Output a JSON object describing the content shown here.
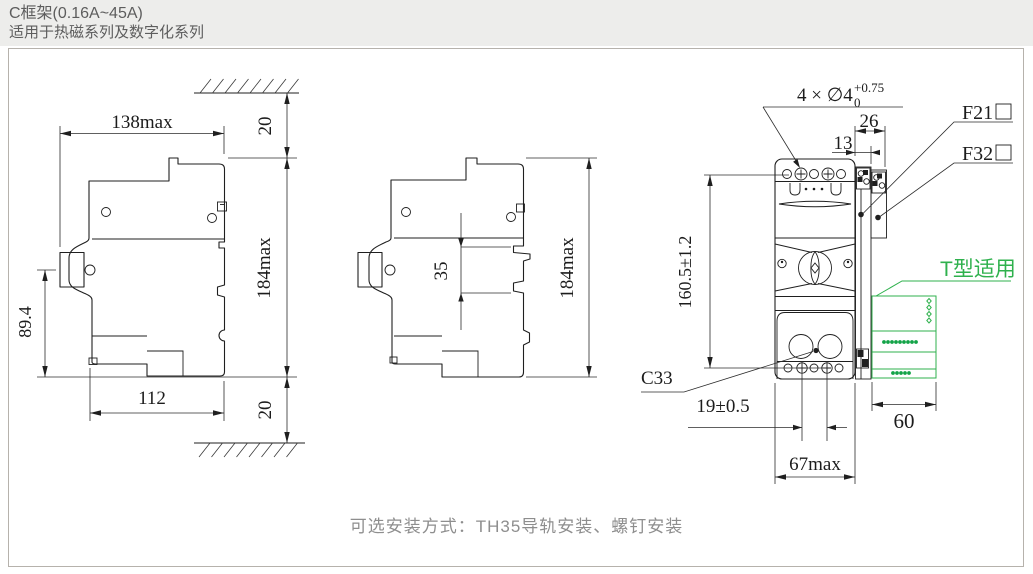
{
  "header": {
    "title": "C框架(0.16A~45A)",
    "subtitle": "适用于热磁系列及数字化系列"
  },
  "footer": {
    "caption": "可选安装方式：TH35导轨安装、螺钉安装"
  },
  "colors": {
    "header_bg": "#ededeb",
    "header_text": "#5d5d5d",
    "line": "#1f1f1f",
    "accent_green": "#2fb14d",
    "caption_text": "#8e8e8e",
    "frame_border": "#b6b2ac"
  },
  "left_view": {
    "dim_width_top": "138max",
    "dim_gap_top": "20",
    "dim_height": "184max",
    "dim_handle_height": "89.4",
    "dim_width_bottom": "112",
    "dim_gap_bottom": "20"
  },
  "middle_view": {
    "dim_rail_slot": "35",
    "dim_height": "184max"
  },
  "front_view": {
    "callout_holes": "4 × ∅4",
    "callout_tol_sup": "+0.75",
    "callout_tol_sub": "0",
    "dim_acc_total_width": "26",
    "dim_acc_f21_width": "13",
    "label_f21": "F21",
    "label_f32": "F32",
    "label_t_type": "T型适用",
    "dim_height_tolerance": "160.5±1.2",
    "label_c33": "C33",
    "dim_hole_pitch": "19±0.5",
    "dim_width": "67max",
    "dim_t_module_width": "60"
  }
}
